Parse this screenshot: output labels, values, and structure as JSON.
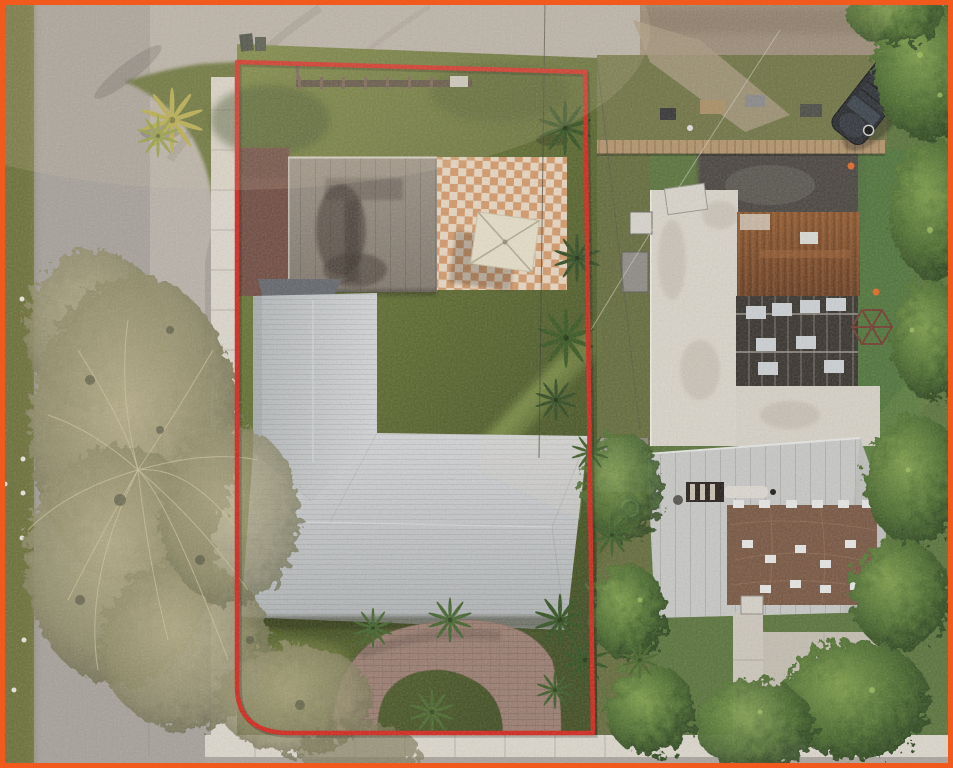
{
  "meta": {
    "type": "aerial-drone-photograph",
    "description": "Overhead aerial photo of a residential corner lot outlined with a red property-boundary line; gray-roof L-shaped house with circular paver driveway, rear guest building with checkered patio and umbrella, large bare tree over the corner street, neighboring property to the east with white flat roof, rusted metal roof, silver metal roof with brown tarp, turf yard, parked dark SUV and dense trees.",
    "width": 953,
    "height": 768,
    "visible_text": ""
  },
  "frame": {
    "color": "#f2591d",
    "width_px": 5,
    "style_attr": "border-color:#f2591d"
  },
  "boundary": {
    "label": "property boundary outline",
    "color": "#d2251a",
    "stroke_width": 4.5,
    "corners": [
      [
        237,
        62
      ],
      [
        585,
        72
      ],
      [
        593,
        733
      ],
      [
        286,
        733
      ],
      [
        237,
        688
      ]
    ],
    "bottom_left_corner_radius": 45
  },
  "colors": {
    "road_gray": "#a6a099",
    "apron_concrete": "#b8b1a8",
    "dirt_road": "#9c8c77",
    "sidewalk": "#dcd7cc",
    "grass_strip": "#7c7e40",
    "lot_grass_light": "#74823a",
    "lot_grass": "#5a672c",
    "lot_grass_dark": "#3e4c1f",
    "maroon_pad": "#6f4a3f",
    "upper_roof": "#91877b",
    "checker_tan": "#d59a6a",
    "checker_cream": "#ece1cf",
    "umbrella": "#e4ddc6",
    "roof_light": "#d2d4d5",
    "roof_mid": "#b4b7b9",
    "paver_driveway": "#9a7c6f",
    "neighbor_turf": "#587239",
    "asphalt_patch": "#47433e",
    "fence_tan": "#b2936a",
    "white_roof": "#d9d4c9",
    "rust_roof": "#7c4a28",
    "dark_framing": "#35302a",
    "silver_roof": "#c7c7c5",
    "tarp_brown": "#76543f",
    "tree_green_dark": "#2c461d",
    "tree_green_light": "#7c9c47",
    "bare_tree": "#b6ad86",
    "bare_tree_edge": "#6b6b4c",
    "palm_yellow": "#b5ab43",
    "suv_body": "#24272b",
    "cone_orange": "#e06820",
    "pool_dark": "#1e3340"
  },
  "scene": {
    "elements": [
      {
        "name": "street-left",
        "desc": "gray asphalt street running north-south on west side"
      },
      {
        "name": "street-top",
        "desc": "dirt/asphalt street running east-west at top"
      },
      {
        "name": "intersection-apron",
        "desc": "light concrete street corner at top-left"
      },
      {
        "name": "sidewalk-west",
        "desc": "white sidewalk along west edge of lot"
      },
      {
        "name": "sidewalk-south",
        "desc": "white sidewalk along bottom edge"
      },
      {
        "name": "corner-palm-tree",
        "desc": "yellow-green palm on corner grass mound"
      },
      {
        "name": "bare-tree",
        "desc": "large sparse leafless tree over street, bottom-left"
      },
      {
        "name": "guest-house-roof",
        "desc": "taupe stained roof of rear building"
      },
      {
        "name": "checkered-patio",
        "desc": "tan and cream checkerboard tile patio"
      },
      {
        "name": "patio-umbrella",
        "desc": "square cream umbrella on patio"
      },
      {
        "name": "maroon-driveway-pad",
        "desc": "old brick-red pavement west of guest house"
      },
      {
        "name": "main-house-roof",
        "desc": "L-shaped light gray shingle roof"
      },
      {
        "name": "circular-driveway",
        "desc": "horseshoe paver driveway with grass island and palm"
      },
      {
        "name": "backyard-fence",
        "desc": "wood fence at rear of lot"
      },
      {
        "name": "neighbor-white-roof",
        "desc": "white flat built-up roof, L-shaped"
      },
      {
        "name": "neighbor-rust-roof",
        "desc": "rusted corrugated metal roof section"
      },
      {
        "name": "neighbor-open-framing",
        "desc": "dark exposed rafter section with white panels"
      },
      {
        "name": "neighbor-silver-roof",
        "desc": "silver metal roof of front neighbor house"
      },
      {
        "name": "neighbor-tarp",
        "desc": "brown tarp with white patches on silver roof"
      },
      {
        "name": "suv-car",
        "desc": "dark SUV parked diagonally off top street"
      },
      {
        "name": "wood-fence-east",
        "desc": "tan wood fence across neighbor rear yard"
      },
      {
        "name": "turf-yard",
        "desc": "green artificial turf play yard"
      },
      {
        "name": "dome-climber",
        "desc": "geometric dome climber frame"
      },
      {
        "name": "picnic-table",
        "desc": "dark table at top-right"
      },
      {
        "name": "traffic-cones",
        "desc": "orange cones in neighbor yard"
      },
      {
        "name": "power-lines",
        "desc": "thin utility wires crossing the lots"
      },
      {
        "name": "tree-row-east",
        "desc": "dense green trees along right edge"
      }
    ]
  }
}
